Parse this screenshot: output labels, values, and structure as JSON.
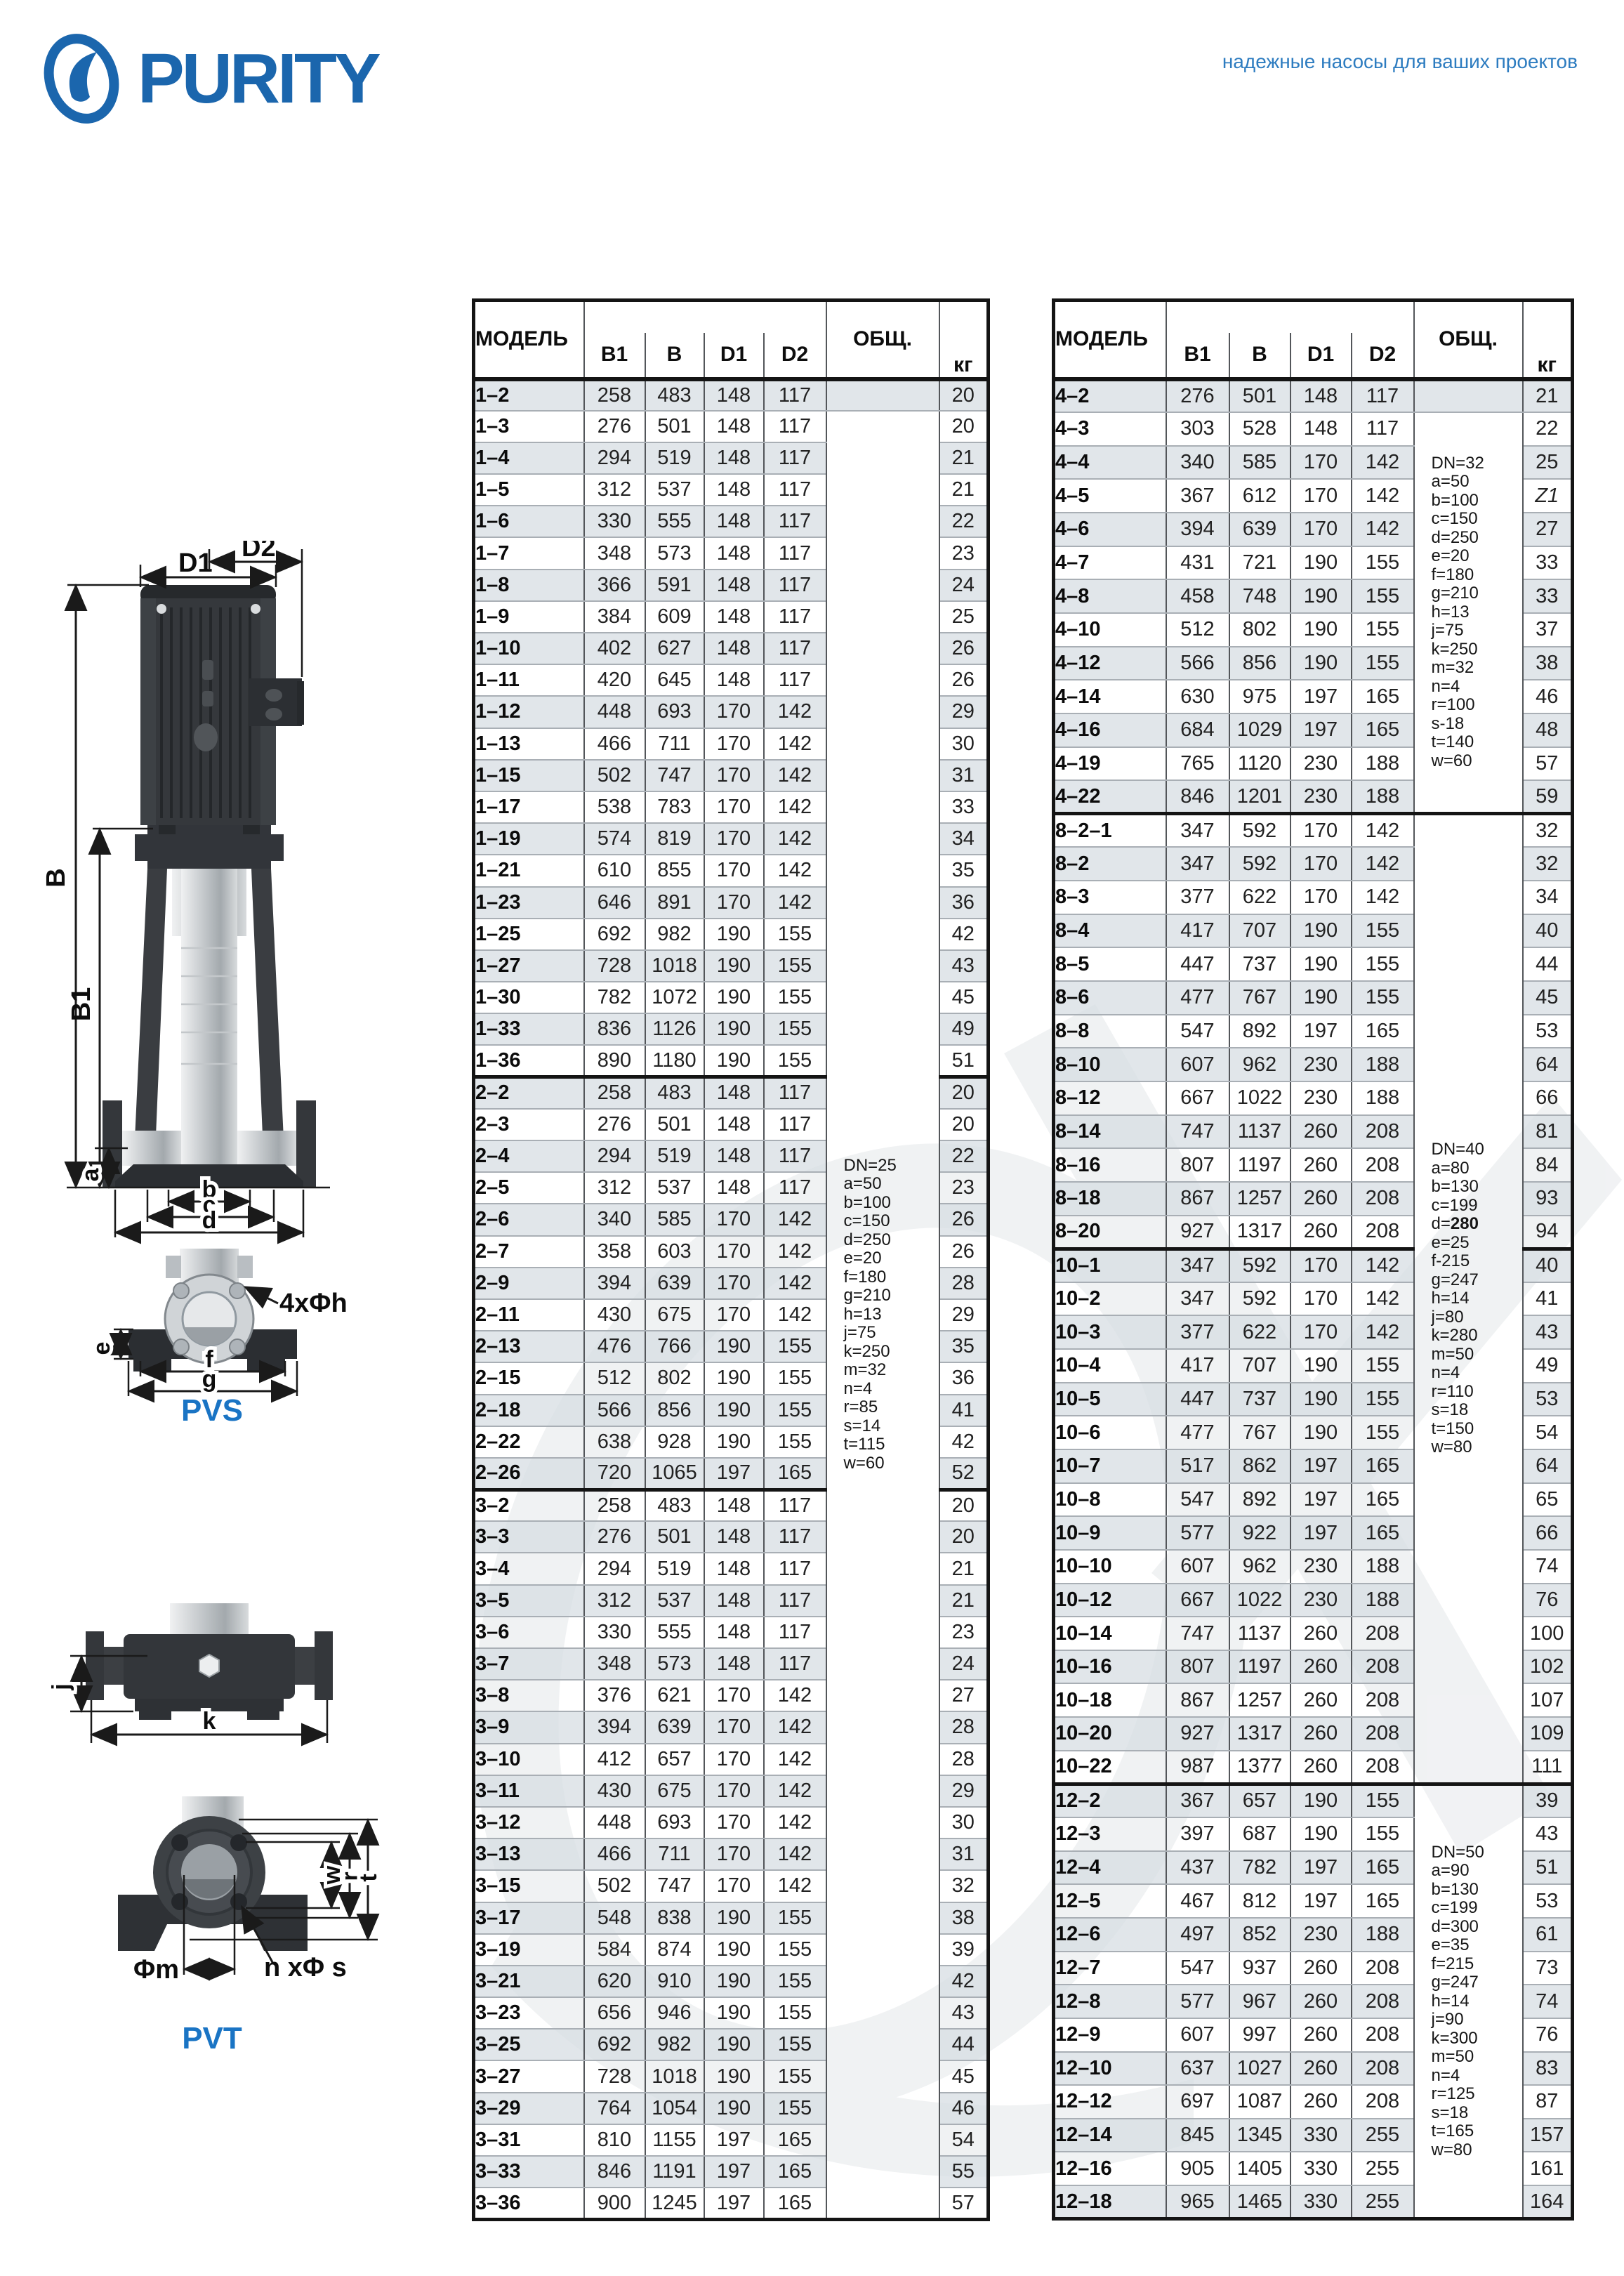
{
  "colors": {
    "brand": "#1b66ad",
    "accent": "#1a74c4",
    "row_shade": "#dce1e6",
    "thick_border": "#141414"
  },
  "header": {
    "logo_text": "PURITY",
    "tagline": "надежные насосы для ваших проектов"
  },
  "diagrams": {
    "pvs_label": "PVS",
    "pvt_label": "PVT",
    "d1": "D1",
    "d2": "D2",
    "b_cap": "B",
    "b1_cap": "B1",
    "a": "a",
    "b": "b",
    "c": "c",
    "d": "d",
    "e": "e",
    "f": "f",
    "g": "g",
    "bolt4": "4xΦh",
    "j": "j",
    "k": "k",
    "w": "w",
    "r": "r",
    "t": "t",
    "phi_m": "Φm",
    "n_phi_s": "n xΦ s"
  },
  "tables": {
    "columns": [
      "МОДЕЛЬ",
      "B1",
      "B",
      "D1",
      "D2",
      "ОБЩ.",
      "кг"
    ],
    "left": {
      "sections": [
        22,
        35
      ],
      "notes": [
        {
          "start": 1,
          "span": 57,
          "lines": [
            "DN=25",
            "a=50",
            "b=100",
            "c=150",
            "d=250",
            "e=20",
            "f=180",
            "g=210",
            "h=13",
            "j=75",
            "k=250",
            "m=32",
            "n=4",
            "r=85",
            "s=14",
            "t=115",
            "w=60"
          ]
        }
      ],
      "rows": [
        [
          "1–2",
          258,
          483,
          148,
          117,
          "20"
        ],
        [
          "1–3",
          276,
          501,
          148,
          117,
          "20"
        ],
        [
          "1–4",
          294,
          519,
          148,
          117,
          "21"
        ],
        [
          "1–5",
          312,
          537,
          148,
          117,
          "21"
        ],
        [
          "1–6",
          330,
          555,
          148,
          117,
          "22"
        ],
        [
          "1–7",
          348,
          573,
          148,
          117,
          "23"
        ],
        [
          "1–8",
          366,
          591,
          148,
          117,
          "24"
        ],
        [
          "1–9",
          384,
          609,
          148,
          117,
          "25"
        ],
        [
          "1–10",
          402,
          627,
          148,
          117,
          "26"
        ],
        [
          "1–11",
          420,
          645,
          148,
          117,
          "26"
        ],
        [
          "1–12",
          448,
          693,
          170,
          142,
          "29"
        ],
        [
          "1–13",
          466,
          711,
          170,
          142,
          "30"
        ],
        [
          "1–15",
          502,
          747,
          170,
          142,
          "31"
        ],
        [
          "1–17",
          538,
          783,
          170,
          142,
          "33"
        ],
        [
          "1–19",
          574,
          819,
          170,
          142,
          "34"
        ],
        [
          "1–21",
          610,
          855,
          170,
          142,
          "35"
        ],
        [
          "1–23",
          646,
          891,
          170,
          142,
          "36"
        ],
        [
          "1–25",
          692,
          982,
          190,
          155,
          "42"
        ],
        [
          "1–27",
          728,
          1018,
          190,
          155,
          "43"
        ],
        [
          "1–30",
          782,
          1072,
          190,
          155,
          "45"
        ],
        [
          "1–33",
          836,
          1126,
          190,
          155,
          "49"
        ],
        [
          "1–36",
          890,
          1180,
          190,
          155,
          "51"
        ],
        [
          "2–2",
          258,
          483,
          148,
          117,
          "20"
        ],
        [
          "2–3",
          276,
          501,
          148,
          117,
          "20"
        ],
        [
          "2–4",
          294,
          519,
          148,
          117,
          "22"
        ],
        [
          "2–5",
          312,
          537,
          148,
          117,
          "23"
        ],
        [
          "2–6",
          340,
          585,
          170,
          142,
          "26"
        ],
        [
          "2–7",
          358,
          603,
          170,
          142,
          "26"
        ],
        [
          "2–9",
          394,
          639,
          170,
          142,
          "28"
        ],
        [
          "2–11",
          430,
          675,
          170,
          142,
          "29"
        ],
        [
          "2–13",
          476,
          766,
          190,
          155,
          "35"
        ],
        [
          "2–15",
          512,
          802,
          190,
          155,
          "36"
        ],
        [
          "2–18",
          566,
          856,
          190,
          155,
          "41"
        ],
        [
          "2–22",
          638,
          928,
          190,
          155,
          "42"
        ],
        [
          "2–26",
          720,
          1065,
          197,
          165,
          "52"
        ],
        [
          "3–2",
          258,
          483,
          148,
          117,
          "20"
        ],
        [
          "3–3",
          276,
          501,
          148,
          117,
          "20"
        ],
        [
          "3–4",
          294,
          519,
          148,
          117,
          "21"
        ],
        [
          "3–5",
          312,
          537,
          148,
          117,
          "21"
        ],
        [
          "3–6",
          330,
          555,
          148,
          117,
          "23"
        ],
        [
          "3–7",
          348,
          573,
          148,
          117,
          "24"
        ],
        [
          "3–8",
          376,
          621,
          170,
          142,
          "27"
        ],
        [
          "3–9",
          394,
          639,
          170,
          142,
          "28"
        ],
        [
          "3–10",
          412,
          657,
          170,
          142,
          "28"
        ],
        [
          "3–11",
          430,
          675,
          170,
          142,
          "29"
        ],
        [
          "3–12",
          448,
          693,
          170,
          142,
          "30"
        ],
        [
          "3–13",
          466,
          711,
          170,
          142,
          "31"
        ],
        [
          "3–15",
          502,
          747,
          170,
          142,
          "32"
        ],
        [
          "3–17",
          548,
          838,
          190,
          155,
          "38"
        ],
        [
          "3–19",
          584,
          874,
          190,
          155,
          "39"
        ],
        [
          "3–21",
          620,
          910,
          190,
          155,
          "42"
        ],
        [
          "3–23",
          656,
          946,
          190,
          155,
          "43"
        ],
        [
          "3–25",
          692,
          982,
          190,
          155,
          "44"
        ],
        [
          "3–27",
          728,
          1018,
          190,
          155,
          "45"
        ],
        [
          "3–29",
          764,
          1054,
          190,
          155,
          "46"
        ],
        [
          "3–31",
          810,
          1155,
          197,
          165,
          "54"
        ],
        [
          "3–33",
          846,
          1191,
          197,
          165,
          "55"
        ],
        [
          "3–36",
          900,
          1245,
          197,
          165,
          "57"
        ]
      ]
    },
    "right": {
      "sections": [
        13,
        26,
        42
      ],
      "notes": [
        {
          "start": 1,
          "span": 12,
          "lines": [
            "DN=32",
            "a=50",
            "b=100",
            "c=150",
            "d=250",
            "e=20",
            "f=180",
            "g=210",
            "h=13",
            "j=75",
            "k=250",
            "m=32",
            "n=4",
            "r=100",
            "s-18",
            "t=140",
            "w=60"
          ]
        },
        {
          "start": 13,
          "span": 29,
          "lines": [
            "DN=40",
            "a=80",
            "b=130",
            "c=199",
            {
              "t": "d=",
              "bt": "280"
            },
            "e=25",
            "f-215",
            "g=247",
            "h=14",
            "j=80",
            "k=280",
            "m=50",
            "n=4",
            "r=110",
            "s=18",
            "t=150",
            "w=80"
          ]
        },
        {
          "start": 42,
          "span": 13,
          "lines": [
            "DN=50",
            "a=90",
            "b=130",
            "c=199",
            "d=300",
            "e=35",
            "f=215",
            "g=247",
            "h=14",
            "j=90",
            "k=300",
            "m=50",
            "n=4",
            "r=125",
            "s=18",
            "t=165",
            "w=80"
          ]
        }
      ],
      "rows": [
        [
          "4–2",
          276,
          501,
          148,
          117,
          "21"
        ],
        [
          "4–3",
          303,
          528,
          148,
          117,
          "22"
        ],
        [
          "4–4",
          340,
          585,
          170,
          142,
          "25"
        ],
        [
          "4–5",
          367,
          612,
          170,
          142,
          "Z1"
        ],
        [
          "4–6",
          394,
          639,
          170,
          142,
          "27"
        ],
        [
          "4–7",
          431,
          721,
          190,
          155,
          "33"
        ],
        [
          "4–8",
          458,
          748,
          190,
          155,
          "33"
        ],
        [
          "4–10",
          512,
          802,
          190,
          155,
          "37"
        ],
        [
          "4–12",
          566,
          856,
          190,
          155,
          "38"
        ],
        [
          "4–14",
          630,
          975,
          197,
          165,
          "46"
        ],
        [
          "4–16",
          684,
          1029,
          197,
          165,
          "48"
        ],
        [
          "4–19",
          765,
          1120,
          230,
          188,
          "57"
        ],
        [
          "4–22",
          846,
          1201,
          230,
          188,
          "59"
        ],
        [
          "8–2–1",
          347,
          592,
          170,
          142,
          "32"
        ],
        [
          "8–2",
          347,
          592,
          170,
          142,
          "32"
        ],
        [
          "8–3",
          377,
          622,
          170,
          142,
          "34"
        ],
        [
          "8–4",
          417,
          707,
          190,
          155,
          "40"
        ],
        [
          "8–5",
          447,
          737,
          190,
          155,
          "44"
        ],
        [
          "8–6",
          477,
          767,
          190,
          155,
          "45"
        ],
        [
          "8–8",
          547,
          892,
          197,
          165,
          "53"
        ],
        [
          "8–10",
          607,
          962,
          230,
          188,
          "64"
        ],
        [
          "8–12",
          667,
          1022,
          230,
          188,
          "66"
        ],
        [
          "8–14",
          747,
          1137,
          260,
          208,
          "81"
        ],
        [
          "8–16",
          807,
          1197,
          260,
          208,
          "84"
        ],
        [
          "8–18",
          867,
          1257,
          260,
          208,
          "93"
        ],
        [
          "8–20",
          927,
          1317,
          260,
          208,
          "94"
        ],
        [
          "10–1",
          347,
          592,
          170,
          142,
          "40"
        ],
        [
          "10–2",
          347,
          592,
          170,
          142,
          "41"
        ],
        [
          "10–3",
          377,
          622,
          170,
          142,
          "43"
        ],
        [
          "10–4",
          417,
          707,
          190,
          155,
          "49"
        ],
        [
          "10–5",
          447,
          737,
          190,
          155,
          "53"
        ],
        [
          "10–6",
          477,
          767,
          190,
          155,
          "54"
        ],
        [
          "10–7",
          517,
          862,
          197,
          165,
          "64"
        ],
        [
          "10–8",
          547,
          892,
          197,
          165,
          "65"
        ],
        [
          "10–9",
          577,
          922,
          197,
          165,
          "66"
        ],
        [
          "10–10",
          607,
          962,
          230,
          188,
          "74"
        ],
        [
          "10–12",
          667,
          1022,
          230,
          188,
          "76"
        ],
        [
          "10–14",
          747,
          1137,
          260,
          208,
          "100"
        ],
        [
          "10–16",
          807,
          1197,
          260,
          208,
          "102"
        ],
        [
          "10–18",
          867,
          1257,
          260,
          208,
          "107"
        ],
        [
          "10–20",
          927,
          1317,
          260,
          208,
          "109"
        ],
        [
          "10–22",
          987,
          1377,
          260,
          208,
          "111"
        ],
        [
          "12–2",
          367,
          657,
          190,
          155,
          "39"
        ],
        [
          "12–3",
          397,
          687,
          190,
          155,
          "43"
        ],
        [
          "12–4",
          437,
          782,
          197,
          165,
          "51"
        ],
        [
          "12–5",
          467,
          812,
          197,
          165,
          "53"
        ],
        [
          "12–6",
          497,
          852,
          230,
          188,
          "61"
        ],
        [
          "12–7",
          547,
          937,
          260,
          208,
          "73"
        ],
        [
          "12–8",
          577,
          967,
          260,
          208,
          "74"
        ],
        [
          "12–9",
          607,
          997,
          260,
          208,
          "76"
        ],
        [
          "12–10",
          637,
          1027,
          260,
          208,
          "83"
        ],
        [
          "12–12",
          697,
          1087,
          260,
          208,
          "87"
        ],
        [
          "12–14",
          845,
          1345,
          330,
          255,
          "157"
        ],
        [
          "12–16",
          905,
          1405,
          330,
          255,
          "161"
        ],
        [
          "12–18",
          965,
          1465,
          330,
          255,
          "164"
        ]
      ]
    }
  }
}
